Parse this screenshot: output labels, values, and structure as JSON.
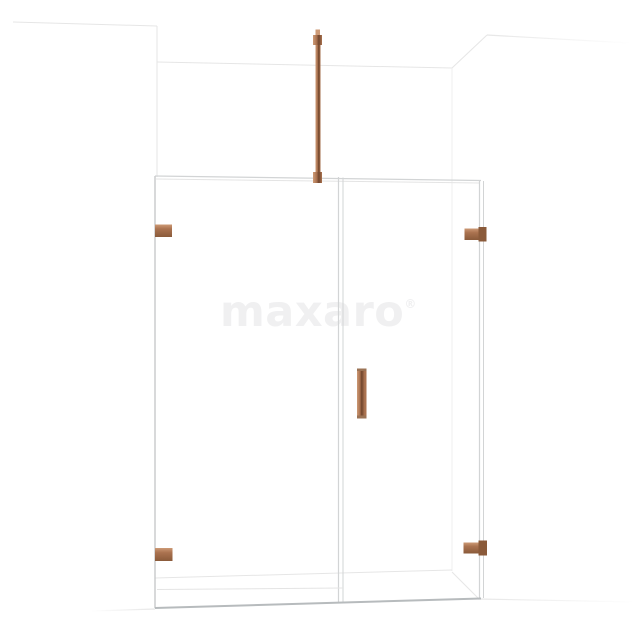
{
  "watermark": {
    "text": "maxaro",
    "registered_mark": "®"
  },
  "colors": {
    "background": "#ffffff",
    "copper": "#ab7350",
    "copper_light": "#cd9a76",
    "copper_dark": "#6f452c",
    "copper_edge": "#8a5a3a",
    "copper_cap": "#9b7355",
    "wall_line": "#e6e6e6",
    "wall_line_soft": "#efefef",
    "glass_line": "#d2d4d5",
    "glass_edge_strong": "#c7c9ca",
    "glass_bottom": "#b7bbbd",
    "glass_faint": "#e4e4e4",
    "watermark_gray": "#f0f0f1"
  }
}
